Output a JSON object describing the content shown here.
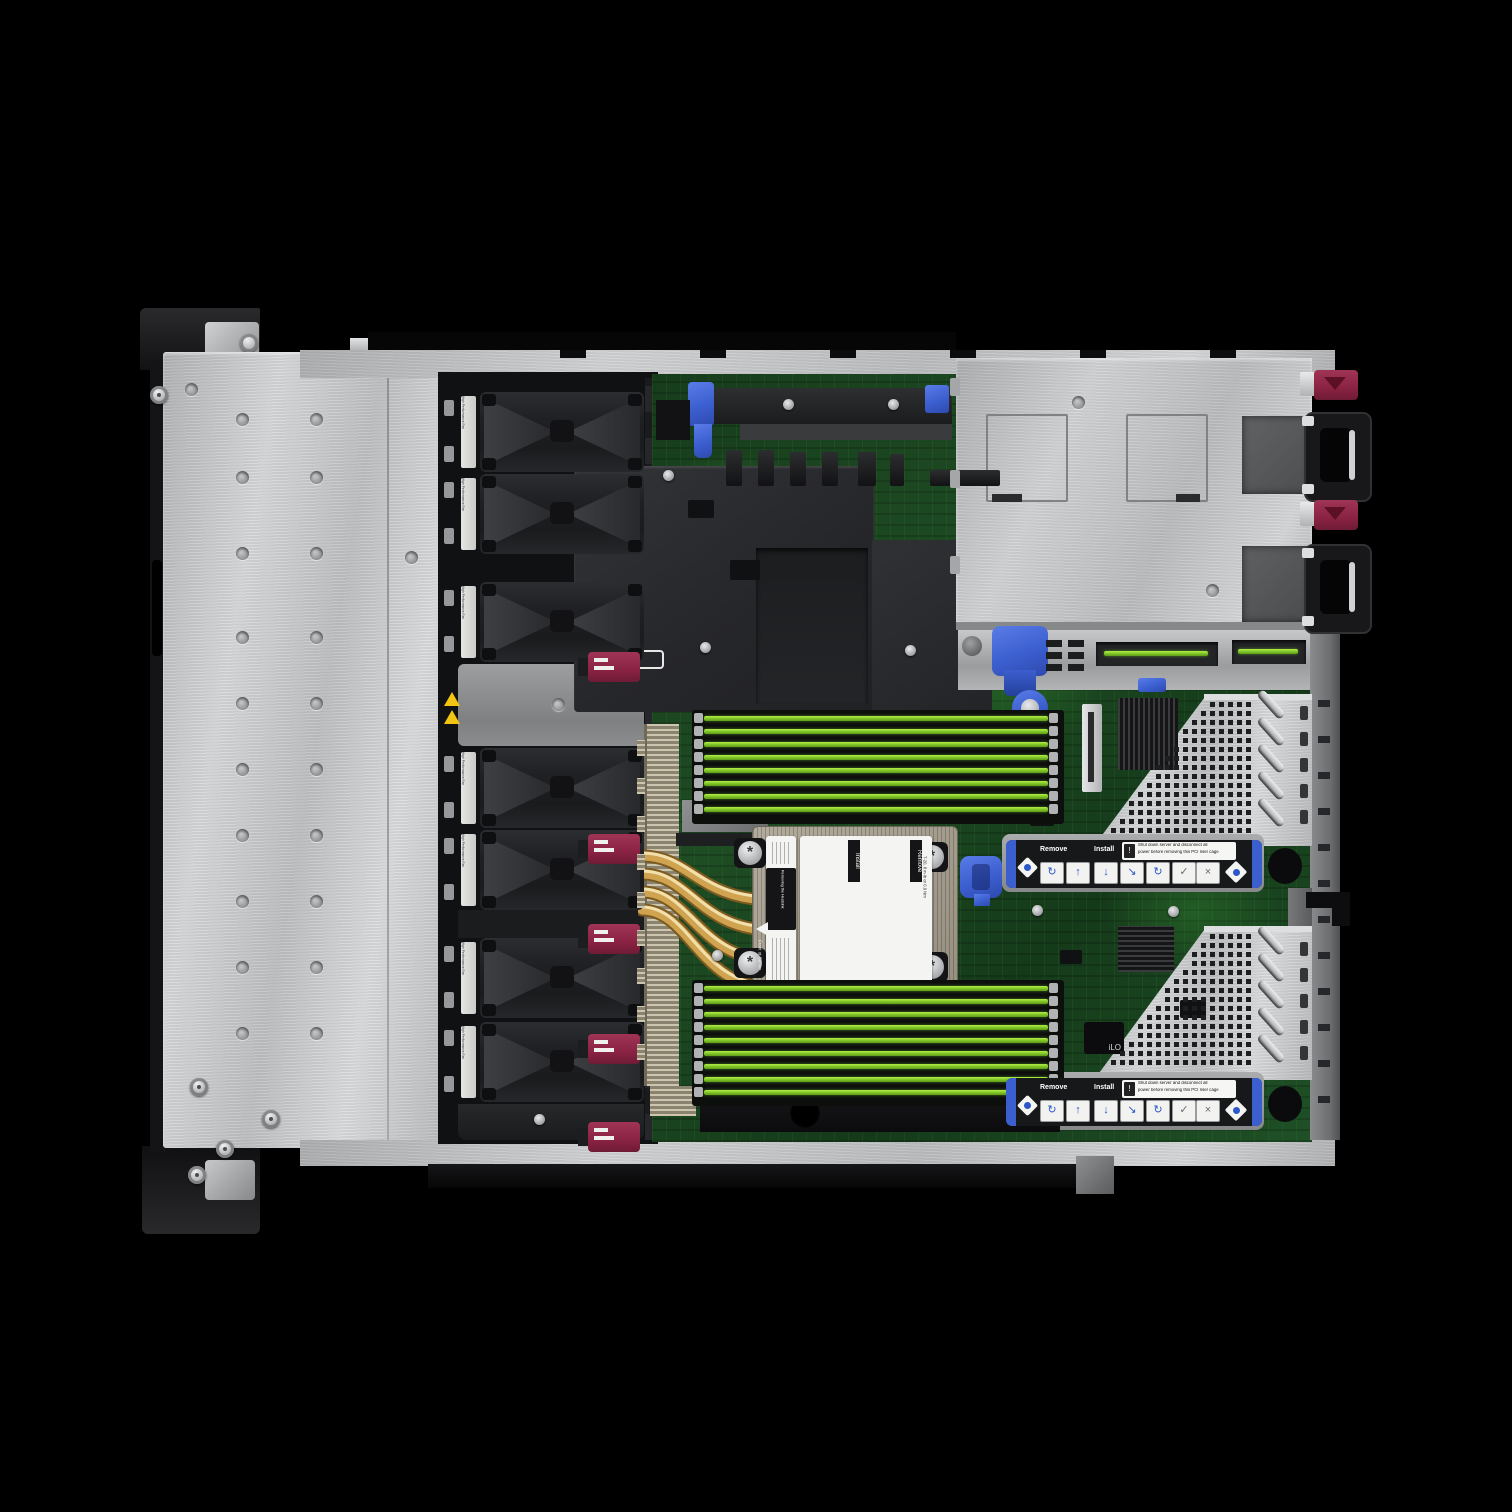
{
  "scene": {
    "title": "1U rack server internal top view, cover removed",
    "background": "#000000"
  },
  "colors": {
    "accent_blue": "#3c5fd0",
    "hpe_maroon": "#8a2343",
    "pcb_green": "#1e4c23",
    "dimm_slot_green": "#8ed32c",
    "copper_heatpipe": "#cfa34f",
    "chassis_metal": "#c6c8ca",
    "heatsink_tan": "#a79f90"
  },
  "fan_bay": {
    "fan_count": 7,
    "blank_slots": 1,
    "fan_label": "High Performance Fan",
    "connector_count": 5
  },
  "memory": {
    "top_bank_slots": 8,
    "bottom_bank_slots": 9
  },
  "power": {
    "psu_count": 2
  },
  "heatsink_label": {
    "title": "Removing the Heatsink",
    "col_install": "Install",
    "col_remove": "Remove",
    "torque": "T-20, 8 in-lb or 0.9 Nm",
    "front_marker": "Front of Server"
  },
  "riser_cages": [
    {
      "id": "primary-riser",
      "remove_label": "Remove",
      "install_label": "Install",
      "warning_line1": "Shut down server and disconnect all",
      "warning_line2": "power before removing this PCI riser cage"
    },
    {
      "id": "secondary-riser",
      "remove_label": "Remove",
      "install_label": "Install",
      "warning_line1": "Shut down server and disconnect all",
      "warning_line2": "power before removing this PCI riser cage"
    }
  ],
  "chip_labels": {
    "ilo": "iLO"
  },
  "warning": {
    "exclamation": "!"
  }
}
